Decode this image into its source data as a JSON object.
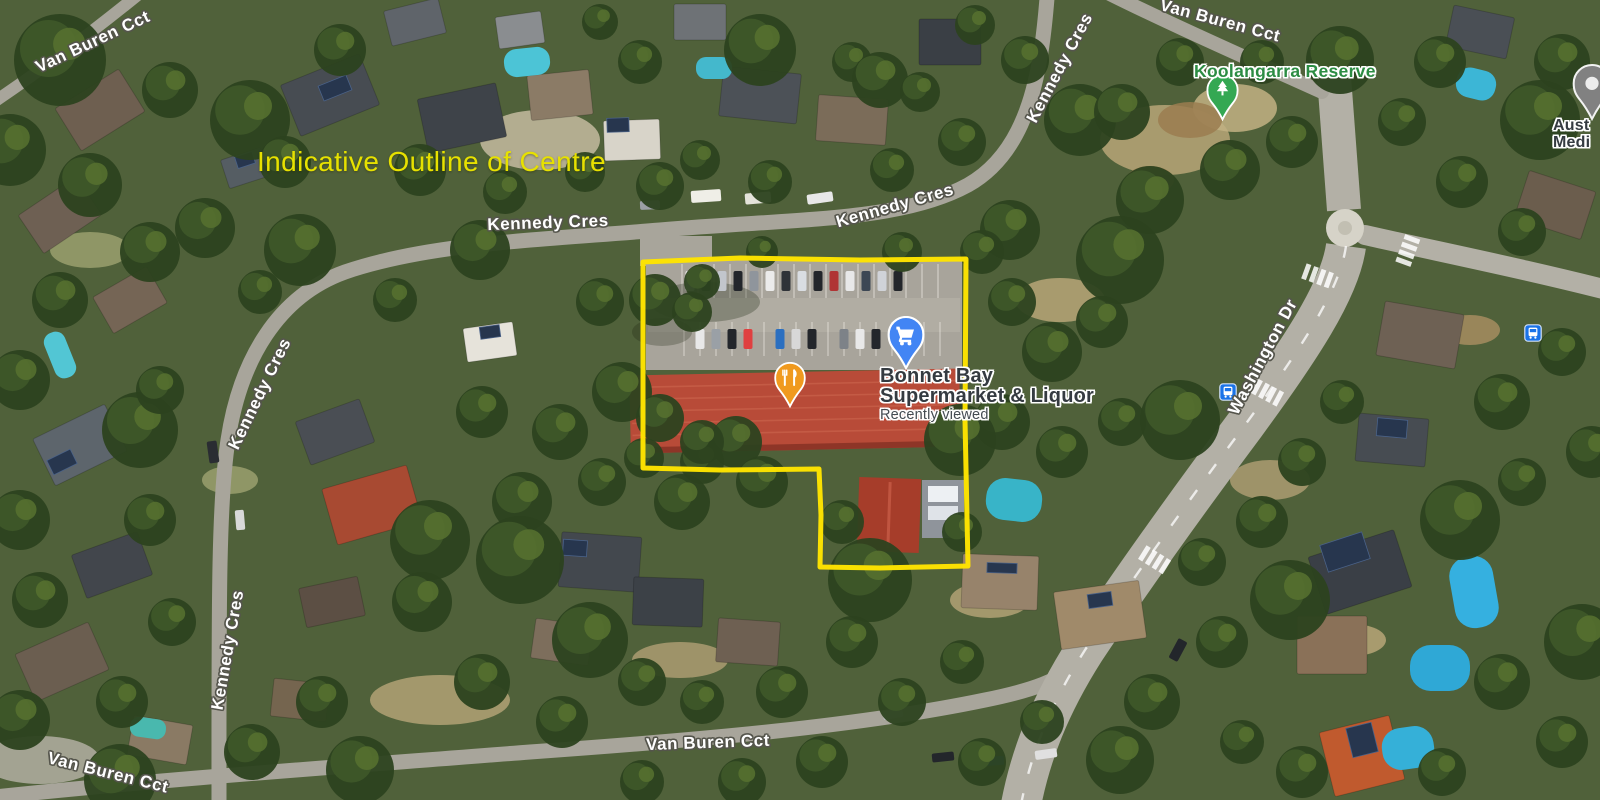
{
  "annotation": {
    "heading": "Indicative Outline of Centre",
    "heading_color": "#E7E100",
    "outline_color": "#FFE400"
  },
  "streets": [
    {
      "id": "van-buren-top-left",
      "text": "Van Buren Cct"
    },
    {
      "id": "kennedy-top-center",
      "text": "Kennedy Cres"
    },
    {
      "id": "kennedy-top-mid",
      "text": "Kennedy Cres"
    },
    {
      "id": "kennedy-top-right",
      "text": "Kennedy Cres"
    },
    {
      "id": "van-buren-top-right",
      "text": "Van Buren Cct"
    },
    {
      "id": "kennedy-left-upper",
      "text": "Kennedy Cres"
    },
    {
      "id": "kennedy-left-lower",
      "text": "Kennedy Cres"
    },
    {
      "id": "washington-dr",
      "text": "Washington Dr"
    },
    {
      "id": "van-buren-bottom-center",
      "text": "Van Buren Cct"
    },
    {
      "id": "van-buren-bottom-left",
      "text": "Van Buren Cct"
    }
  ],
  "pois": {
    "reserve": {
      "label": "Koolangarra Reserve",
      "color": "#2C8C43"
    },
    "supermarket": {
      "line1": "Bonnet Bay",
      "line2": "Supermarket & Liquor",
      "status": "Recently viewed"
    },
    "edge_clipped": {
      "line1": "Aust",
      "line2": "Medi"
    }
  },
  "pins": {
    "restaurant": {
      "icon": "restaurant-pin",
      "color": "#F09A1F"
    },
    "shopping": {
      "icon": "shopping-cart-pin",
      "color": "#4285F4"
    },
    "park": {
      "icon": "tree-pin",
      "color": "#34A853"
    },
    "generic": {
      "icon": "generic-poi-pin",
      "color": "#818181"
    },
    "bus": {
      "icon": "bus-stop-icon",
      "color": "#1A73E8",
      "count": 2
    }
  }
}
